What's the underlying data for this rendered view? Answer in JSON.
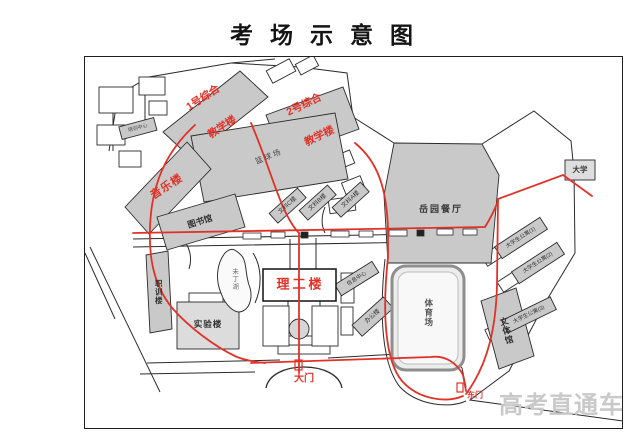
{
  "title": "考场示意图",
  "watermark": "高考直通车",
  "colors": {
    "route_red": "#e13228",
    "label_red": "#e13228",
    "building_gray": "#c9c9c9",
    "watermark_gray": "#c9c9c9",
    "line_black": "#2b2b2b"
  },
  "map": {
    "gates": {
      "main": "大门",
      "east": "东门"
    },
    "red_labels": {
      "teaching1_l1": "1号综合",
      "teaching1_l2": "教学楼",
      "teaching2_l1": "2号综合",
      "teaching2_l2": "教学楼",
      "music": "音乐楼",
      "ligong": "理工楼"
    },
    "buildings": {
      "basketball": "篮球场",
      "library": "图书馆",
      "yueyuan": "岳园餐厅",
      "stadium": "体育场",
      "wenti": "文体馆",
      "zhixun": "职训楼",
      "shiyan": "实验楼",
      "lake": "未丁湖",
      "office": "办公楼",
      "center": "信息中心",
      "print": "培训中心",
      "daxue": "大学",
      "wenke1": "文科C楼",
      "wenke2": "文科B楼",
      "wenke3": "文科A楼",
      "apt1": "大学生公寓(1)",
      "apt2": "大学生公寓(2)",
      "apt3": "大学生公寓(3)"
    }
  }
}
